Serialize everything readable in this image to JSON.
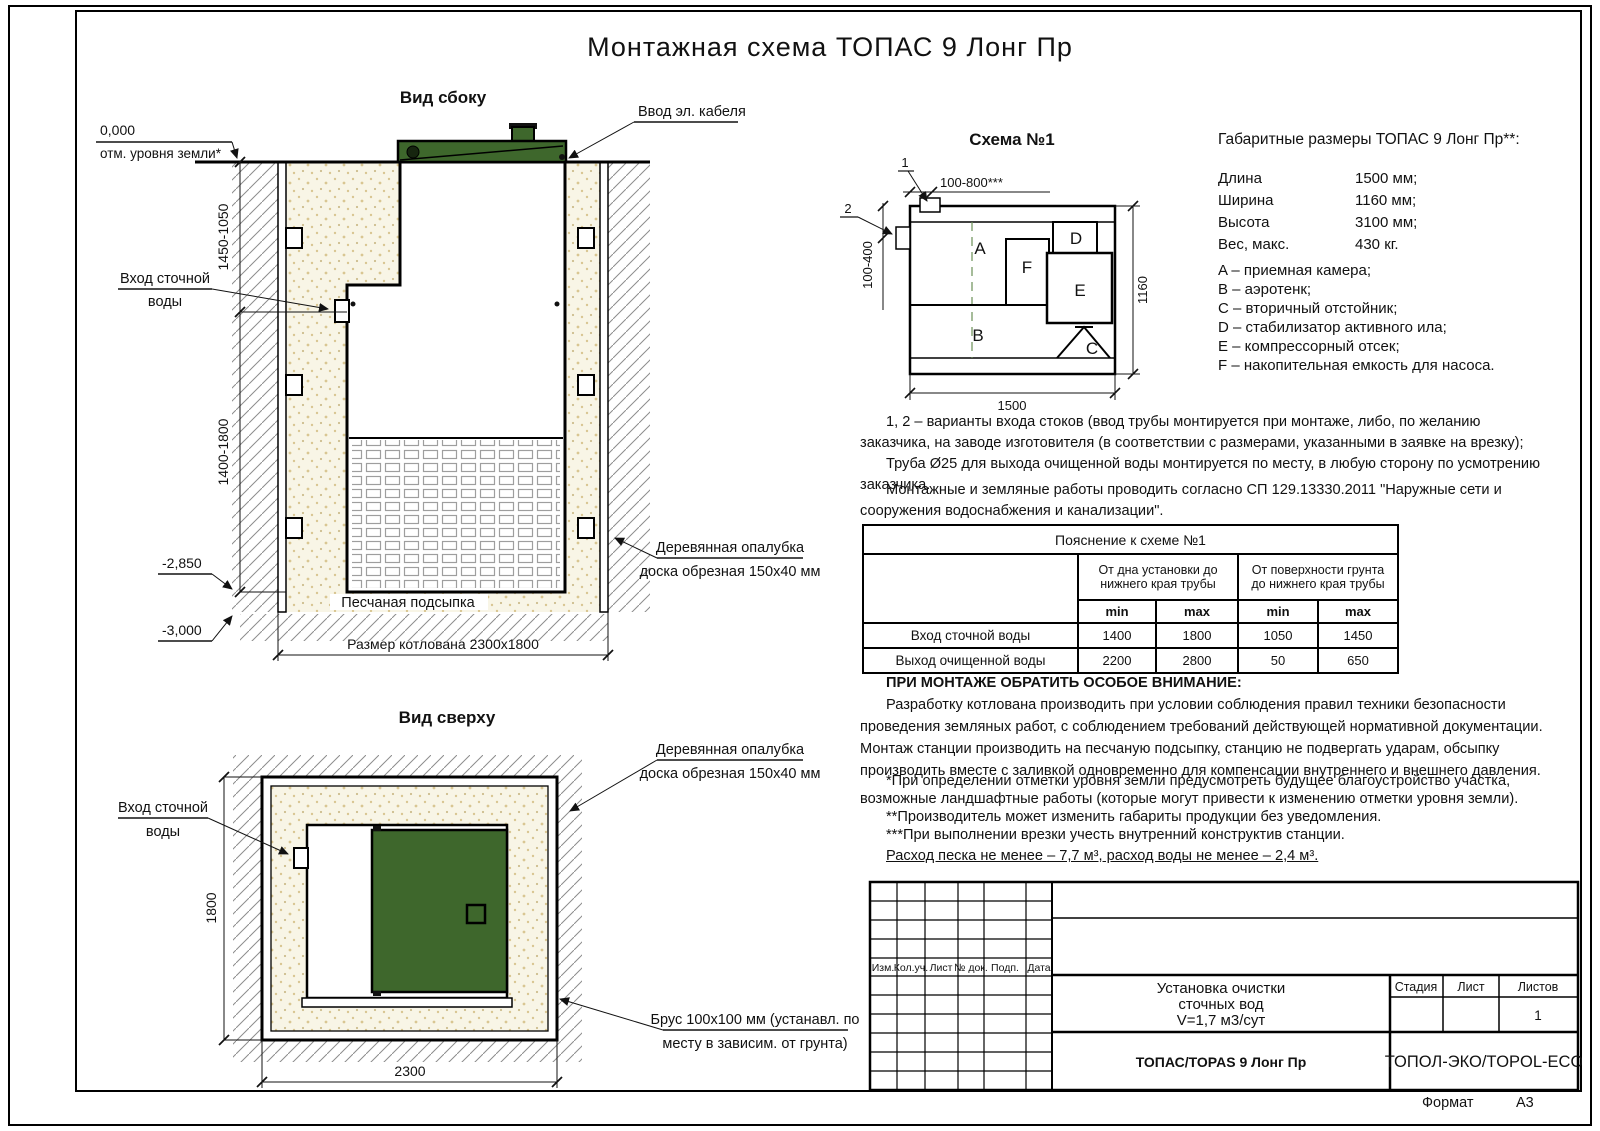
{
  "doc": {
    "title": "Монтажная схема ТОПАС 9 Лонг Пр",
    "format_label": "Формат",
    "format_value": "А3"
  },
  "side_view": {
    "label": "Вид сбоку",
    "mark_zero": "0,000",
    "ground": "отм. уровня земли*",
    "dim_upper": "1450-1050",
    "dim_lower": "1400-1800",
    "mark_2850": "-2,850",
    "mark_3000": "-3,000",
    "inlet1": "Вход сточной",
    "inlet2": "воды",
    "cable": "Ввод эл. кабеля",
    "formwork1": "Деревянная опалубка",
    "formwork2": "доска обрезная 150x40 мм",
    "sand": "Песчаная подсыпка",
    "pit": "Размер котлована 2300x1800"
  },
  "top_view": {
    "label": "Вид сверху",
    "inlet1": "Вход сточной",
    "inlet2": "воды",
    "formwork1": "Деревянная опалубка",
    "formwork2": "доска обрезная 150x40 мм",
    "beam1": "Брус 100x100 мм (устанавл. по",
    "beam2": "месту в зависим. от грунта)",
    "dim_h": "1800",
    "dim_w": "2300"
  },
  "schema": {
    "label": "Схема №1",
    "m1": "1",
    "m2": "2",
    "dim_top": "100-800***",
    "dim_left": "100-400",
    "dim_right": "1160",
    "dim_bottom": "1500",
    "comp": {
      "a": "A",
      "b": "B",
      "c": "C",
      "d": "D",
      "e": "E",
      "f": "F"
    }
  },
  "specs": {
    "title": "Габаритные размеры ТОПАС 9 Лонг Пр**:",
    "rows": [
      {
        "name": "Длина",
        "value": "1500 мм;"
      },
      {
        "name": "Ширина",
        "value": "1160 мм;"
      },
      {
        "name": "Высота",
        "value": "3100 мм;"
      },
      {
        "name": "Вес, макс.",
        "value": "430 кг."
      }
    ],
    "legend": [
      "A – приемная камера;",
      "B – аэротенк;",
      "C – вторичный отстойник;",
      "D – стабилизатор активного ила;",
      "E – компрессорный отсек;",
      "F – накопительная емкость для насоса."
    ]
  },
  "notes": {
    "para1a": "1, 2 – варианты входа  стоков (ввод трубы монтируется при монтаже, либо, по желанию заказчика, на заводе изготовителя (в соответствии с размерами, указанными в заявке на врезку);",
    "para1b": "Труба Ø25 для выхода очищенной воды монтируется по месту, в любую сторону по усмотрению заказчика.",
    "para2": "Монтажные и земляные работы проводить согласно СП 129.13330.2011 \"Наружные сети и сооружения водоснабжения и канализации\".",
    "attn_title": "ПРИ МОНТАЖЕ ОБРАТИТЬ ОСОБОЕ ВНИМАНИЕ:",
    "attn_body": "Разработку котлована производить при условии соблюдения правил техники безопасности проведения земляных работ, с соблюдением требований действующей нормативной документации. Монтаж станции производить на песчаную подсыпку, станцию не подвергать ударам, обсыпку производить вместе с заливкой одновременно для компенсации внутреннего и внешнего давления.",
    "star1": "*При определении отметки уровня земли предусмотреть будущее благоустройство участка, возможные ландшафтные работы (которые могут привести к изменению отметки уровня земли).",
    "star2": "**Производитель может изменить габариты продукции без уведомления.",
    "star3": "***При выполнении врезки учесть внутренний конструктив станции.",
    "consumption": "Расход песка не менее – 7,7 м³, расход воды не менее – 2,4 м³."
  },
  "table": {
    "title": "Пояснение к схеме №1",
    "g1": "От дна установки до нижнего края трубы",
    "g2": "От поверхности грунта до нижнего края трубы",
    "min": "min",
    "max": "max",
    "rows": [
      {
        "name": "Вход сточной воды",
        "v1": "1400",
        "v2": "1800",
        "v3": "1050",
        "v4": "1450"
      },
      {
        "name": "Выход очищенной воды",
        "v1": "2200",
        "v2": "2800",
        "v3": "50",
        "v4": "650"
      }
    ]
  },
  "title_block": {
    "rev": [
      "Изм.",
      "Кол.уч.",
      "Лист",
      "№ док.",
      "Подп.",
      "Дата"
    ],
    "p1": "Установка очистки",
    "p2": "сточных вод",
    "p3": "V=1,7 м3/сут",
    "stage": "Стадия",
    "sheet": "Лист",
    "sheets": "Листов",
    "sheets_value": "1",
    "model": "ТОПАС/TOPAS 9 Лонг Пр",
    "company": "ТОПОЛ-ЭКО/TOPOL-ECO"
  }
}
